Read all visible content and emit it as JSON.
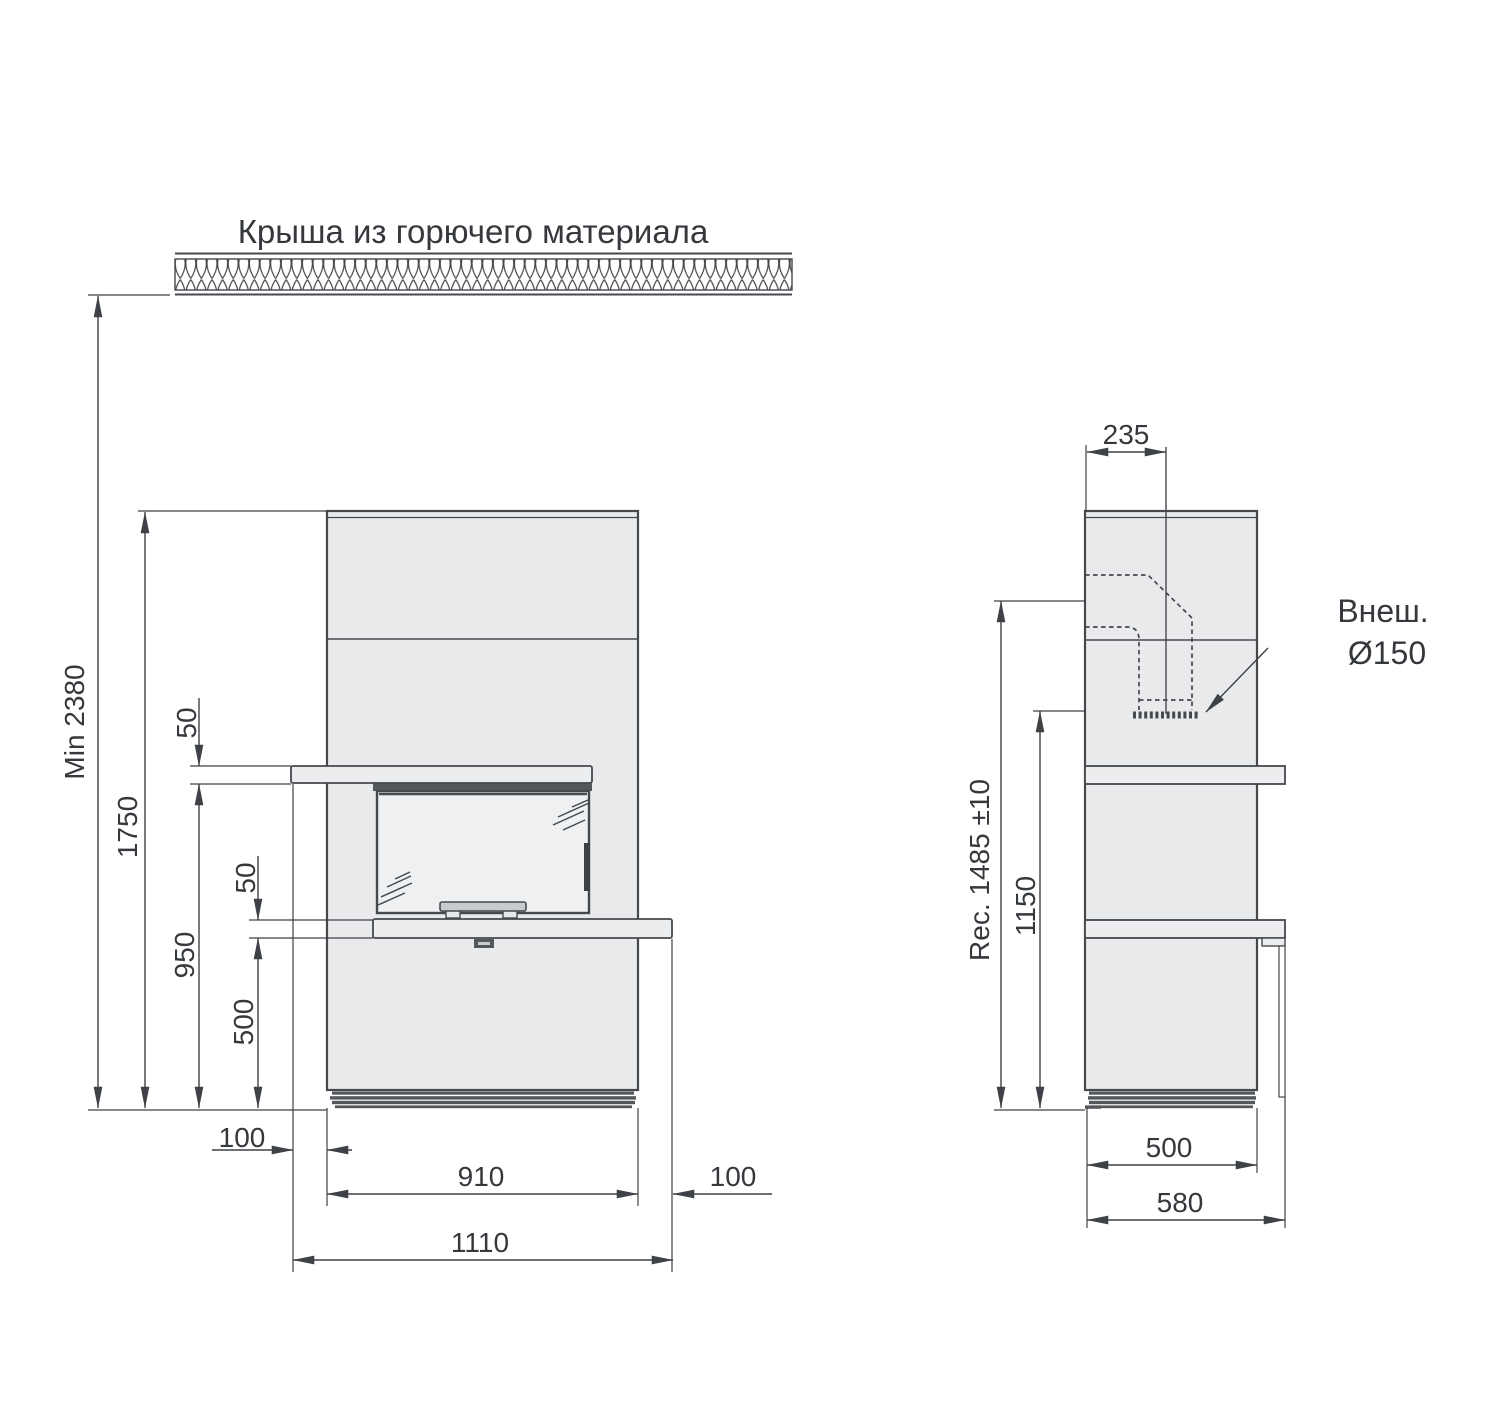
{
  "title": "Крыша из горючего материала",
  "colors": {
    "line": "#45484d",
    "dim_line": "#3e4246",
    "text": "#35383c",
    "body_fill": "#e9eaeb",
    "glass_fill": "#eef0f1",
    "shelf_fill": "#ebedee",
    "dark_fill": "#54575b",
    "background": "#ffffff"
  },
  "front_view": {
    "dims": {
      "min_total": "Min 2380",
      "body_top": "1750",
      "shelf_thickness": "50",
      "under_shelf": "950",
      "hearth_thickness": "50",
      "under_hearth": "500",
      "left_offset": "100",
      "body_width": "910",
      "right_offset": "100",
      "total_width": "1110"
    }
  },
  "side_view": {
    "dims": {
      "flue_center_offset": "235",
      "rec_height": "Rec. 1485 ±10",
      "flue_connect_height": "1150",
      "depth_body": "500",
      "depth_total": "580"
    },
    "flue_note_line1": "Внеш.",
    "flue_note_line2": "Ø150"
  }
}
